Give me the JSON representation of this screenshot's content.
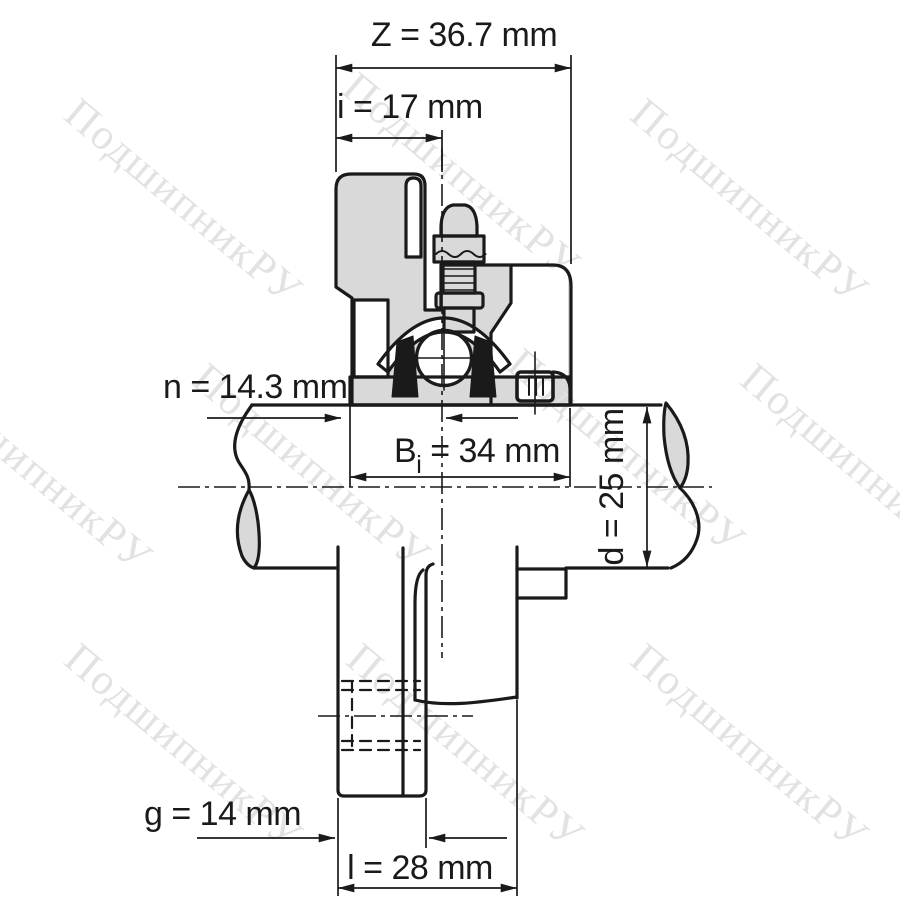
{
  "page": {
    "type": "technical-drawing",
    "subject": "flanged bearing unit cross-section",
    "background_color": "#ffffff",
    "line_color": "#1a1a1a",
    "body_fill_color": "#d9d9d9"
  },
  "watermark": {
    "text": "ПодшипникРУ",
    "color": "#e2e2e2"
  },
  "dimensions": {
    "z": {
      "label": "Z = 36.7 mm"
    },
    "i": {
      "label": "i = 17 mm"
    },
    "n": {
      "label": "n = 14.3 mm"
    },
    "bi": {
      "symbol": "B",
      "subscript": "i",
      "value": " = 34 mm"
    },
    "d": {
      "label": "d = 25 mm"
    },
    "g": {
      "label": "g = 14 mm"
    },
    "l": {
      "label": "l = 28 mm"
    }
  }
}
